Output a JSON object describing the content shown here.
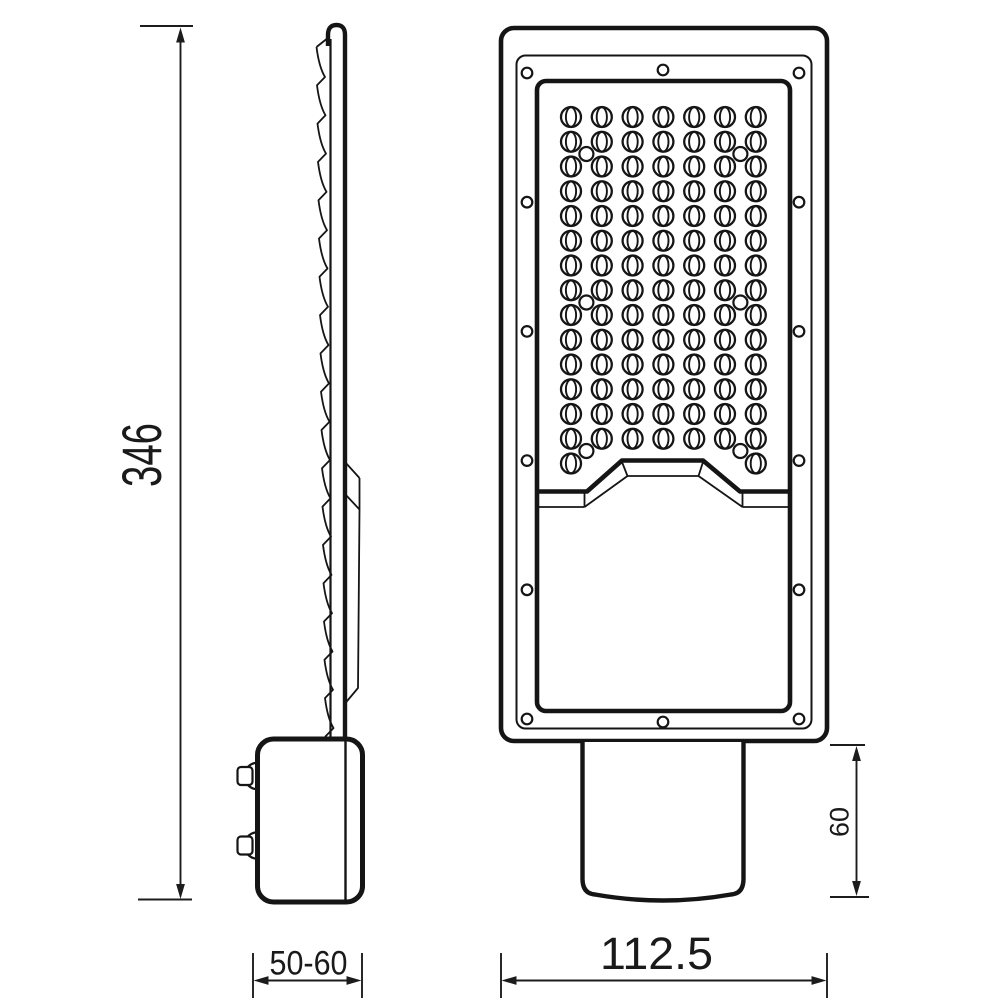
{
  "page": {
    "background": "#ffffff"
  },
  "drawing": {
    "line_color": "#151515",
    "dimension_color": "#1c1c1c",
    "dimensions": {
      "overall_height": "346",
      "pole_diameter_range": "50-60",
      "housing_width": "112.5",
      "mount_socket_height": "60"
    },
    "front_view": {
      "led_grid": {
        "columns": 7,
        "full_rows": 14,
        "partial_row_led_count": 2,
        "total_leds": 100
      },
      "frame_screws_per_side": 6,
      "frame_center_screws": 2,
      "panel_screw_holes": 6
    },
    "side_view": {
      "heatsink_fin_count": 18,
      "terminal_knob_count": 2
    }
  }
}
